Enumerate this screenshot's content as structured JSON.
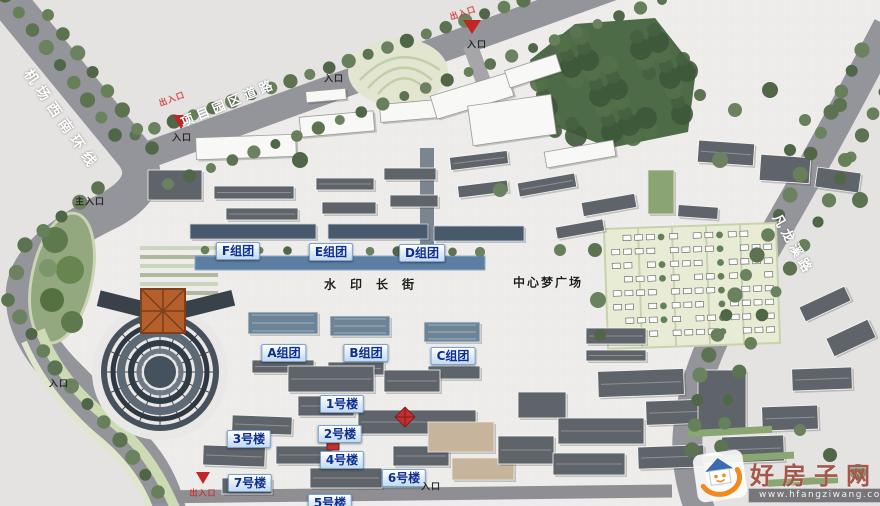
{
  "map": {
    "roads": {
      "left": "机场西南环线",
      "top": "项目园区道路",
      "right": "凡龙溪路"
    },
    "labels": {
      "main_entrance": "主入口",
      "entrance": "入口",
      "red_gate": "出入口",
      "center_plaza": "中心梦广场",
      "water_street": "水印长街"
    },
    "groups": [
      {
        "label": "F组团"
      },
      {
        "label": "E组团"
      },
      {
        "label": "D组团"
      },
      {
        "label": "A组团"
      },
      {
        "label": "B组团"
      },
      {
        "label": "C组团"
      }
    ],
    "buildings": [
      {
        "label": "1号楼"
      },
      {
        "label": "2号楼"
      },
      {
        "label": "3号楼"
      },
      {
        "label": "4号楼"
      },
      {
        "label": "5号楼"
      },
      {
        "label": "6号楼"
      },
      {
        "label": "7号楼"
      }
    ],
    "colors": {
      "road": "#96969c",
      "paving": "#edecea",
      "forest": "#4e6b48",
      "water_street_blue": "#5d7ea3",
      "badge_text": "#0e2f8e",
      "marker_red": "#c42424",
      "watermark_red": "#a7564b"
    }
  },
  "watermark": {
    "site_name": "好房子网",
    "site_url": "www.hfangziwang.com"
  }
}
